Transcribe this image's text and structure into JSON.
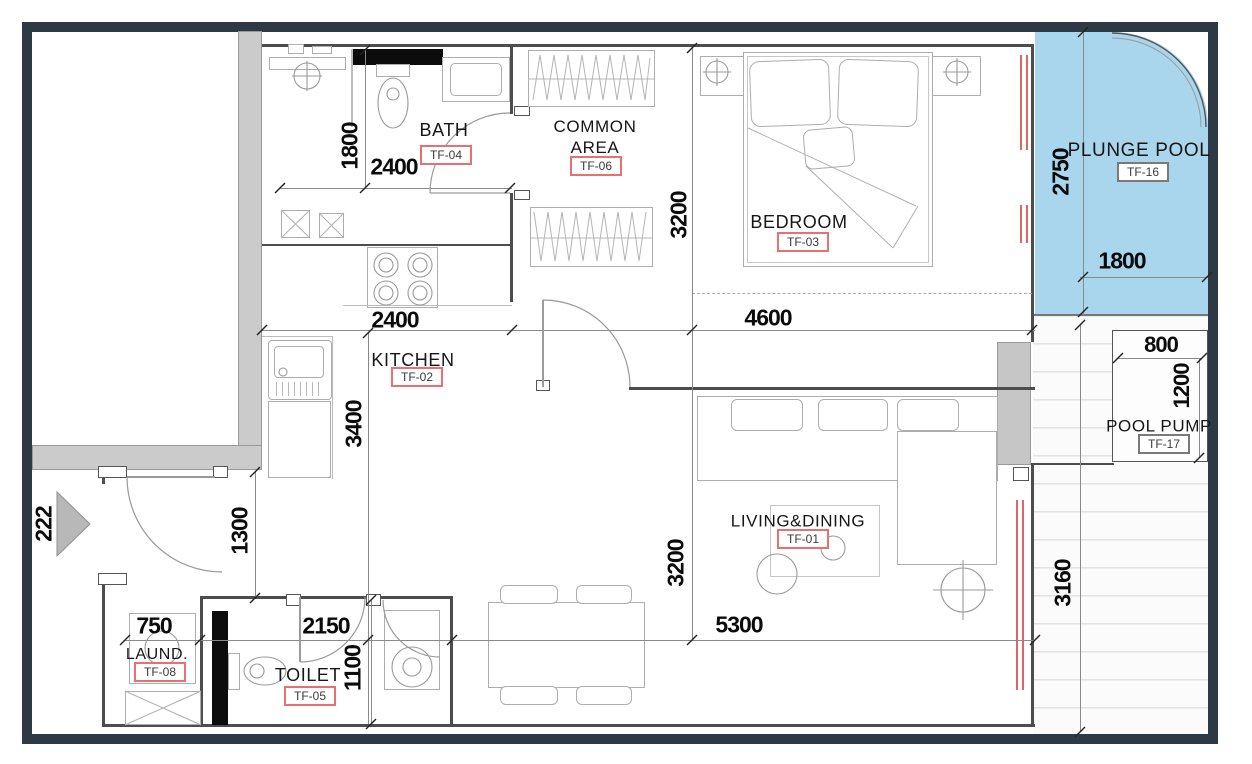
{
  "plan_title": "apartment-floor-plan",
  "colors": {
    "frame": "#2d3a46",
    "pool_fill": "#a9d6ed",
    "wall_gray": "#cbcbcb",
    "tag_red": "#e87070",
    "window_red": "#e06666"
  },
  "rooms": {
    "living": {
      "name": "LIVING&DINING",
      "tag": "TF-01"
    },
    "kitchen": {
      "name": "KITCHEN",
      "tag": "TF-02"
    },
    "bedroom": {
      "name": "BEDROOM",
      "tag": "TF-03"
    },
    "bath": {
      "name": "BATH",
      "tag": "TF-04"
    },
    "toilet": {
      "name": "TOILET",
      "tag": "TF-05"
    },
    "common": {
      "name": "COMMON AREA",
      "tag": "TF-06"
    },
    "laundry": {
      "name": "LAUND.",
      "tag": "TF-08"
    },
    "pool": {
      "name": "PLUNGE POOL",
      "tag": "TF-16"
    },
    "pump": {
      "name": "POOL PUMP",
      "tag": "TF-17"
    }
  },
  "dims": {
    "bath_height": "1800",
    "bath_width": "2400",
    "common_height": "3200",
    "bedroom_width": "4600",
    "pool_height": "2750",
    "pool_width": "1800",
    "kitchen_width": "2400",
    "kitchen_height": "3400",
    "entry_height": "1300",
    "living_height": "3200",
    "living_width": "5300",
    "terrace_height": "3160",
    "laundry_width": "750",
    "toilet_width": "2150",
    "toilet_height": "1100",
    "pump_width": "800",
    "pump_height": "1200",
    "entry_mark": "222"
  }
}
